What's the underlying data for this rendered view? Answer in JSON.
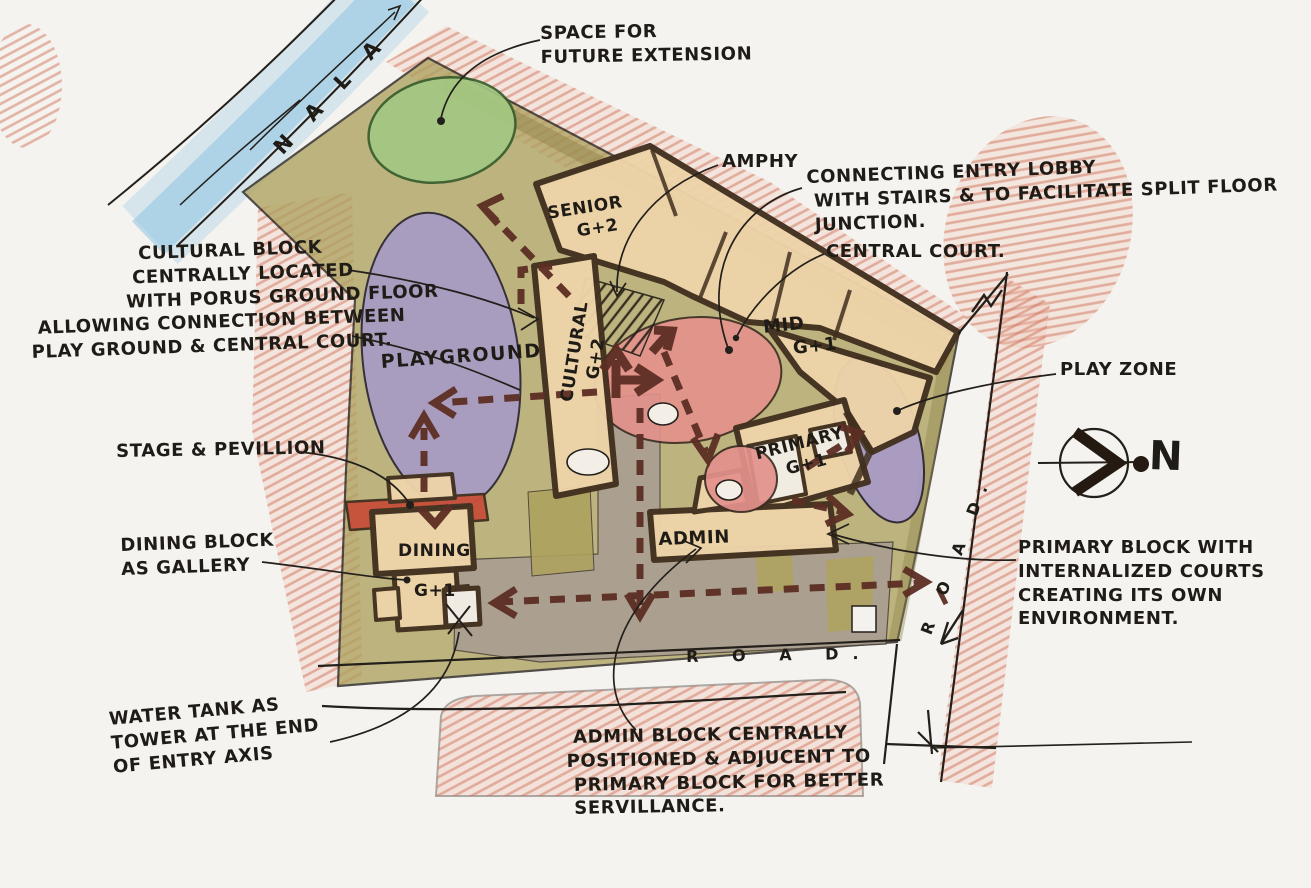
{
  "title": "Hand-drawn school campus concept site plan sketch",
  "annotations": {
    "nala": "N A L A",
    "future_extension": "SPACE FOR\nFUTURE EXTENSION",
    "amphy": "AMPHY",
    "entry_lobby": "CONNECTING ENTRY LOBBY\n WITH STAIRS & TO FACILITATE SPLIT FLOOR\n JUNCTION.",
    "central_court": "CENTRAL COURT.",
    "cultural_note": "                CULTURAL BLOCK\n               CENTRALLY LOCATED\n              WITH PORUS GROUND FLOOR\n ALLOWING CONNECTION BETWEEN\nPLAY GROUND & CENTRAL COURT.",
    "stage_note": "STAGE & PEVILLION",
    "dining_note": "DINING BLOCK\nAS GALLERY",
    "water_tank_note": "WATER TANK AS\nTOWER AT THE END\nOF ENTRY AXIS",
    "admin_note": " ADMIN BLOCK CENTRALLY\nPOSITIONED & ADJUCENT TO\n PRIMARY BLOCK FOR BETTER\n SERVILLANCE.",
    "primary_note": "PRIMARY BLOCK WITH\nINTERNALIZED COURTS\nCREATING ITS OWN\nENVIRONMENT.",
    "play_zone": "PLAY ZONE"
  },
  "blocks": {
    "senior": "SENIOR\n    G+2",
    "cultural": "CULTURAL\n    G+2",
    "mid": "MID\n    G+1",
    "primary": "PRIMARY\n    G+1",
    "admin": "ADMIN",
    "dining": "DINING",
    "dining_floors": "G+1",
    "playground": "PLAYGROUND"
  },
  "roads": {
    "bottom": "R O A D.",
    "right": "R O A D."
  },
  "compass": {
    "label": "N"
  },
  "colors": {
    "paper": "#f5f3ef",
    "ink": "#231f1a",
    "site_olive": "#aea25f",
    "khaki_dark": "#8d8148",
    "building_fill": "#eed4a9",
    "outline_brown": "#42301f",
    "playground_purple": "#a79ac8",
    "court_pink": "#e4918c",
    "future_green": "#a3c983",
    "nala_blue": "#8ec3e2",
    "hatch_red": "#d0715a",
    "crayon_soft": "#eec4b4",
    "plaza_gray": "#a89d92",
    "arrow_maroon": "#5d2e24",
    "stage_red": "#c7503a",
    "court_white": "#f3efe6"
  }
}
